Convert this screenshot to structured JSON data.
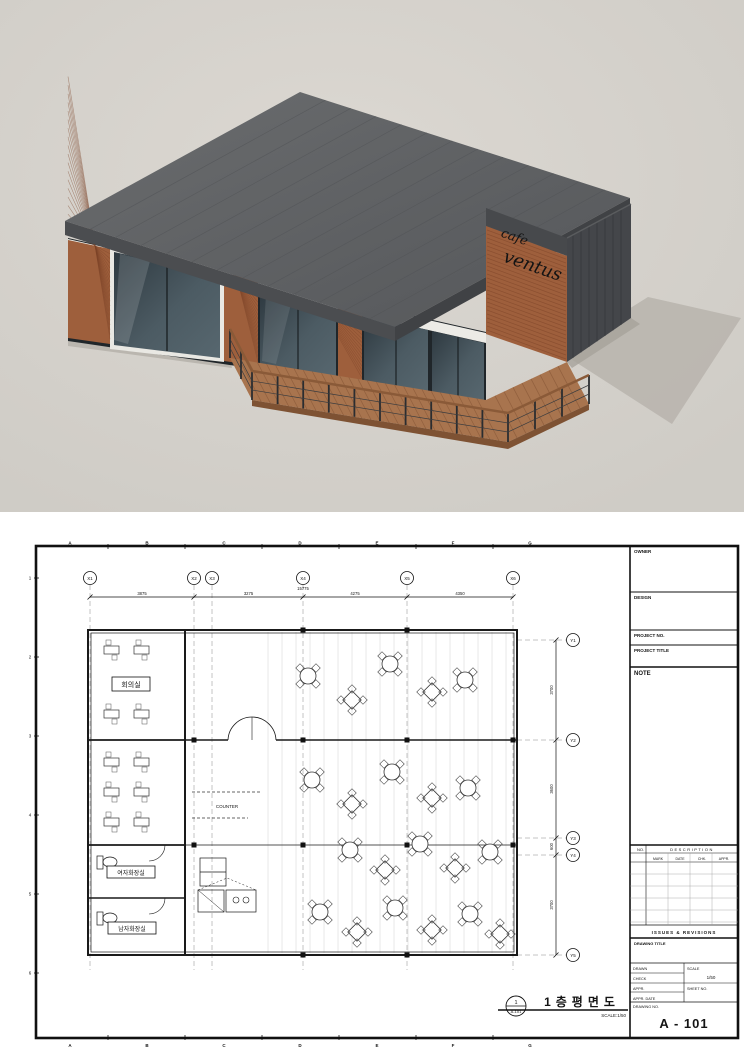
{
  "render": {
    "sign": {
      "line1": "cafe",
      "line2": "ventus"
    },
    "colors": {
      "background": "#d6d2cc",
      "roof": "#5d5f62",
      "brick": "#9e5f3c",
      "glass": "#3c4a52",
      "deck": "#a8744e",
      "shadow": "#b9b5ae"
    }
  },
  "sheet": {
    "edge_letters": [
      "A",
      "B",
      "C",
      "D",
      "E",
      "F",
      "G"
    ],
    "edge_numbers": [
      "1",
      "2",
      "3",
      "4",
      "5",
      "6"
    ],
    "grid_x_labels": [
      "X1",
      "X2",
      "X3",
      "X4",
      "X5",
      "X6"
    ],
    "grid_y_labels": [
      "Y1",
      "Y2",
      "Y3",
      "Y4",
      "Y5"
    ],
    "dims_top": [
      "3875",
      "3275",
      "4275",
      "4350"
    ],
    "dim_top_total": "15775",
    "dims_right": [
      "3700",
      "3600",
      "600",
      "3700"
    ],
    "labels": {
      "meeting_room": "회의실",
      "toilet_women": "여자화장실",
      "toilet_men": "남자화장실",
      "counter": "COUNTER"
    },
    "plan_title": {
      "bubble_number": "1",
      "bubble_sheet": "A-101",
      "title": "1층평면도",
      "scale": "SCALE:1/50"
    },
    "title_block": {
      "owner": "OWNER",
      "design": "DESIGN",
      "project_no": "PROJECT NO.",
      "project_title": "PROJECT TITLE",
      "note": "NOTE",
      "rev_no": "NO.",
      "rev_description": "DESCRIPTION",
      "rev_columns": [
        "MARK",
        "DATE",
        "CHK.",
        "APPR."
      ],
      "issues": "ISSUES & REVISIONS",
      "drawing_title": "DRAWING TITLE",
      "drawn": "DRAWN",
      "check": "CHECK",
      "appr": "APPR.",
      "appr_date": "APPR. DATE",
      "scale": "SCALE",
      "scale_value": "1/50",
      "sheet_no": "SHEET NO.",
      "drawing_no_label": "DRAWING NO.",
      "drawing_no": "A - 101"
    }
  }
}
